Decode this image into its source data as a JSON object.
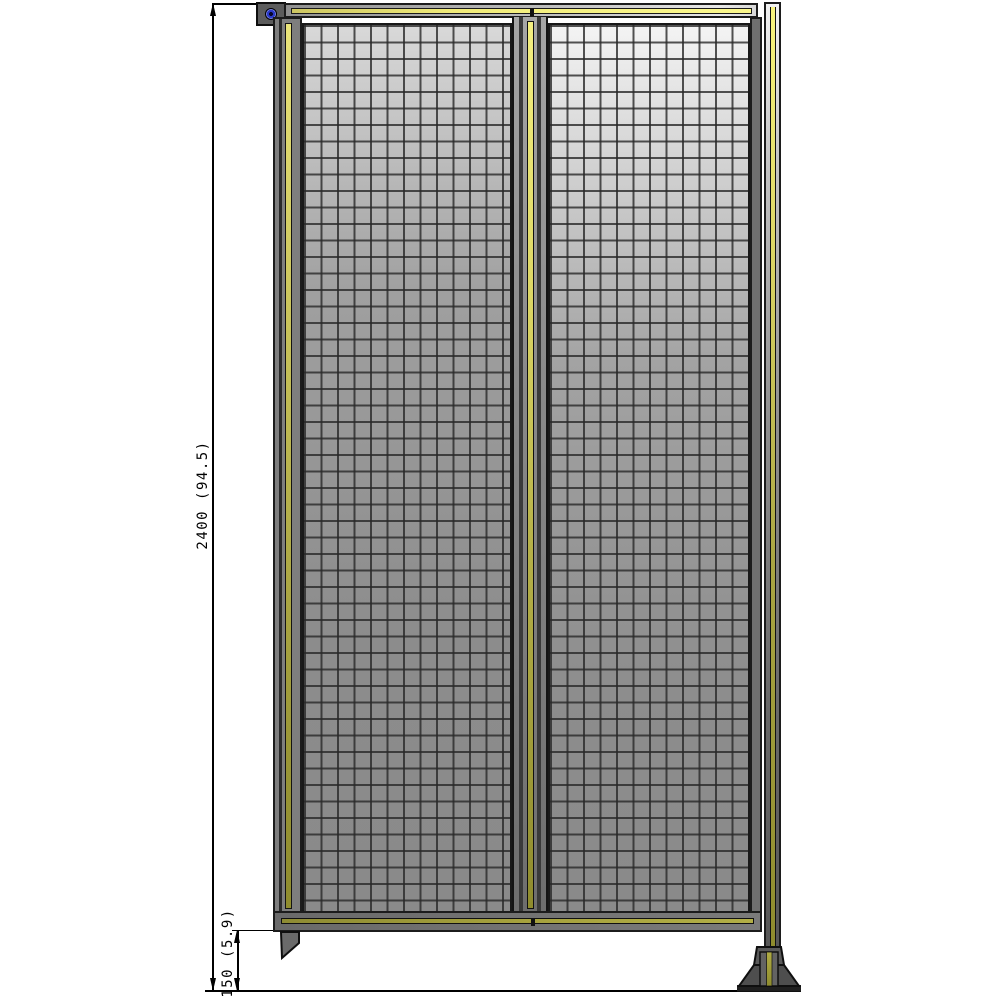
{
  "drawing": {
    "type": "technical-elevation-drawing",
    "subject": "double wire-mesh partition panel with support post and floor foot",
    "background_color": "#ffffff",
    "annotations": {
      "overall_height": {
        "label": "2400 (94.5)",
        "orientation": "vertical",
        "units": "mm (in)"
      },
      "foot_height": {
        "label": "150 (5.9)",
        "orientation": "vertical",
        "units": "mm (in)"
      }
    },
    "parts": {
      "wall_bracket": "top-left mounting bracket with blue bolt head",
      "top_rail": "horizontal rail with yellow accent stripe",
      "mesh_panels": 2,
      "center_divider": "vertical profile with yellow stripe",
      "support_post": "right vertical post with yellow stripe",
      "floor_foot": "trapezoid floor foot with base plate",
      "bottom_bracket": "angled bracket under lower-left rail"
    },
    "colors": {
      "frame_gray": "#7c7c7c",
      "rail_highlight": "#e8e8e8",
      "stripe_yellow_bright": "#fbf88c",
      "stripe_olive_dark": "#8f8c2e",
      "mesh_background": "#8d8d8d",
      "mesh_grid_line": "#2c2c2c",
      "outline_black": "#111111",
      "bolt_blue": "#2a39c8",
      "dimension_line": "#000000"
    },
    "mesh": {
      "cell_size_px": 16.5,
      "grid_line_px": 2
    }
  }
}
